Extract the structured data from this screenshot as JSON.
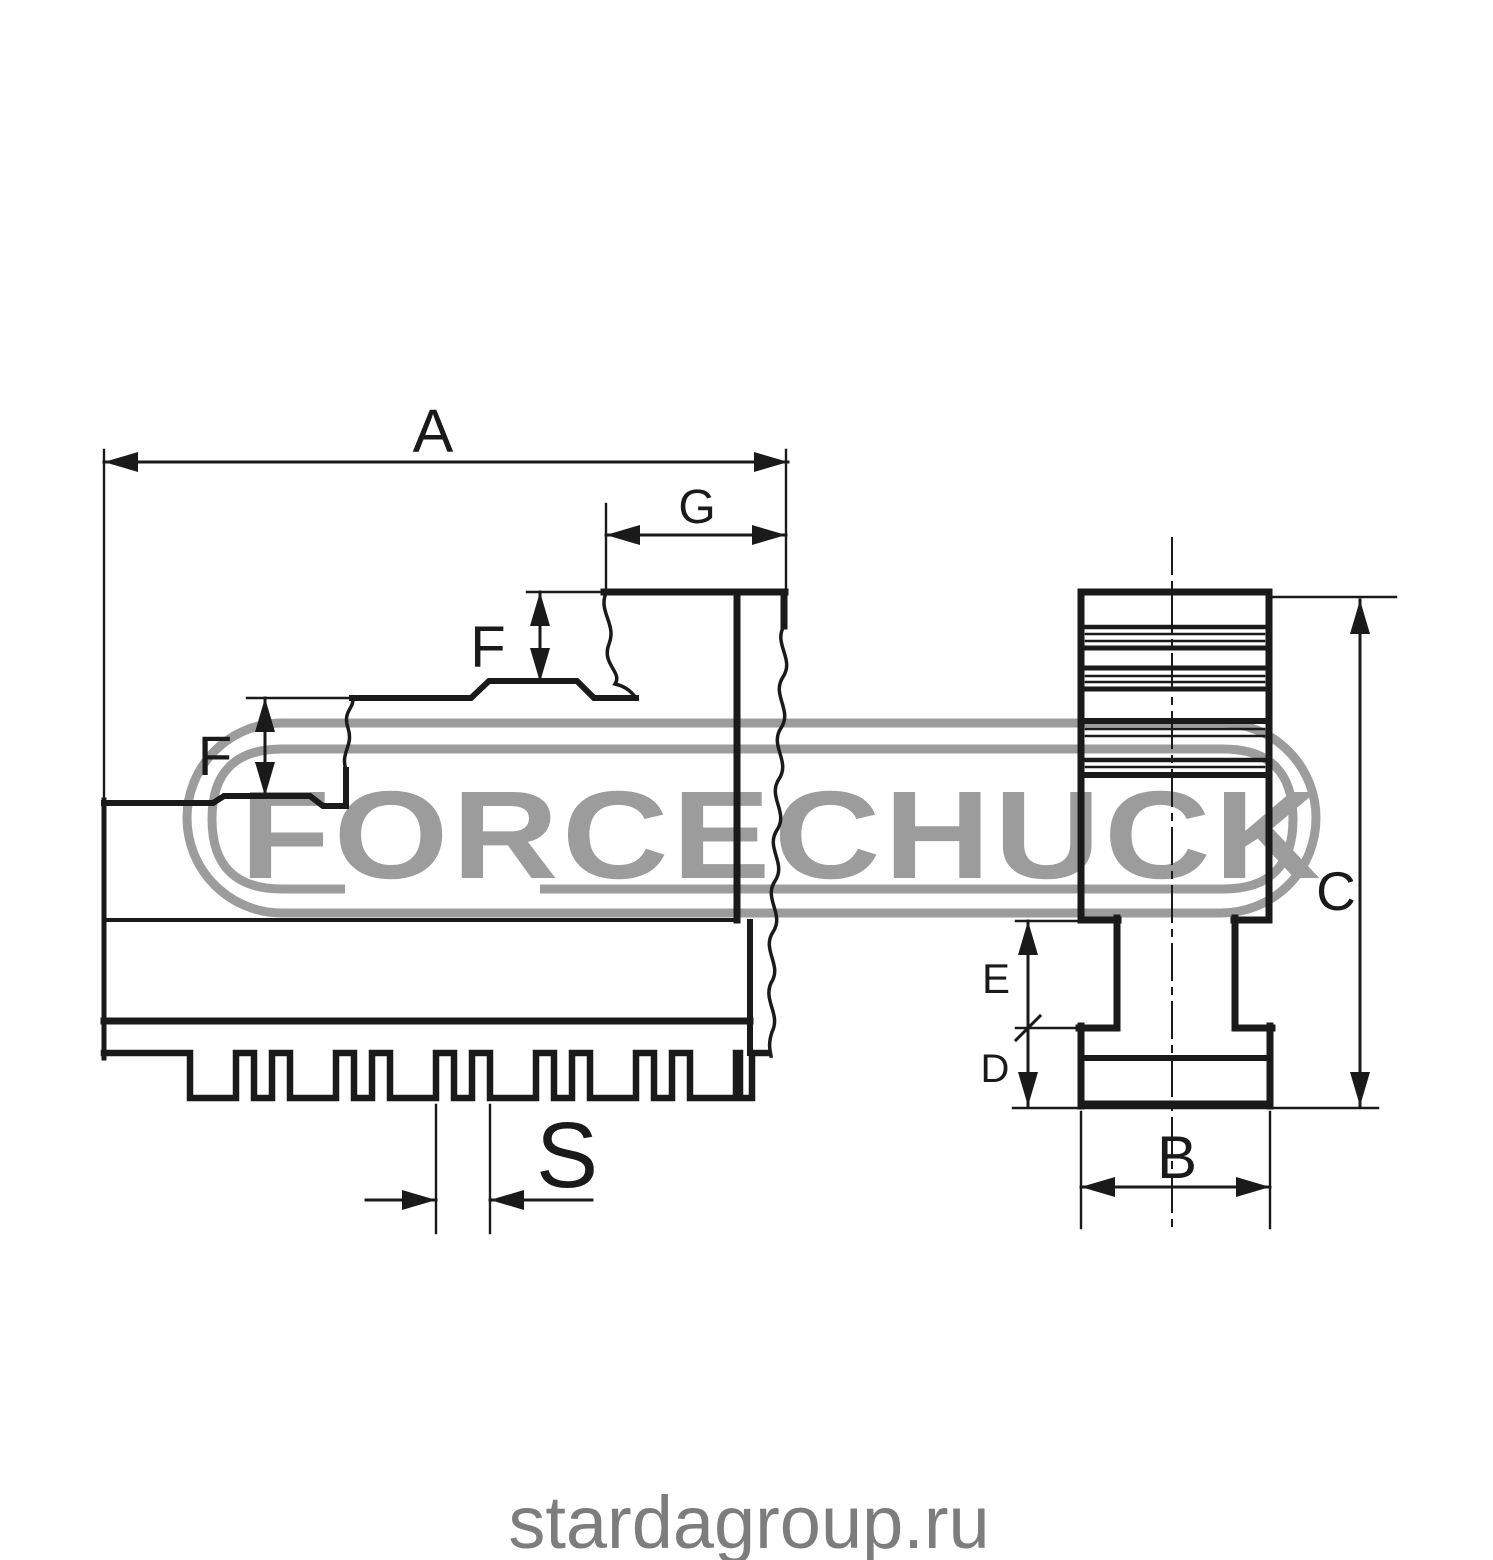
{
  "watermark": {
    "brand": "FORCECHUCK",
    "color": "#9c9c9c"
  },
  "footer": {
    "website": "stardagroup.ru",
    "color": "#7d7d7d"
  },
  "drawing": {
    "ink": "#1a1a1a",
    "background": "#ffffff",
    "labels": {
      "a": "A",
      "g": "G",
      "f_upper": "F",
      "f_lower": "F",
      "s": "S",
      "c": "C",
      "e": "E",
      "d": "D",
      "b": "B"
    }
  }
}
